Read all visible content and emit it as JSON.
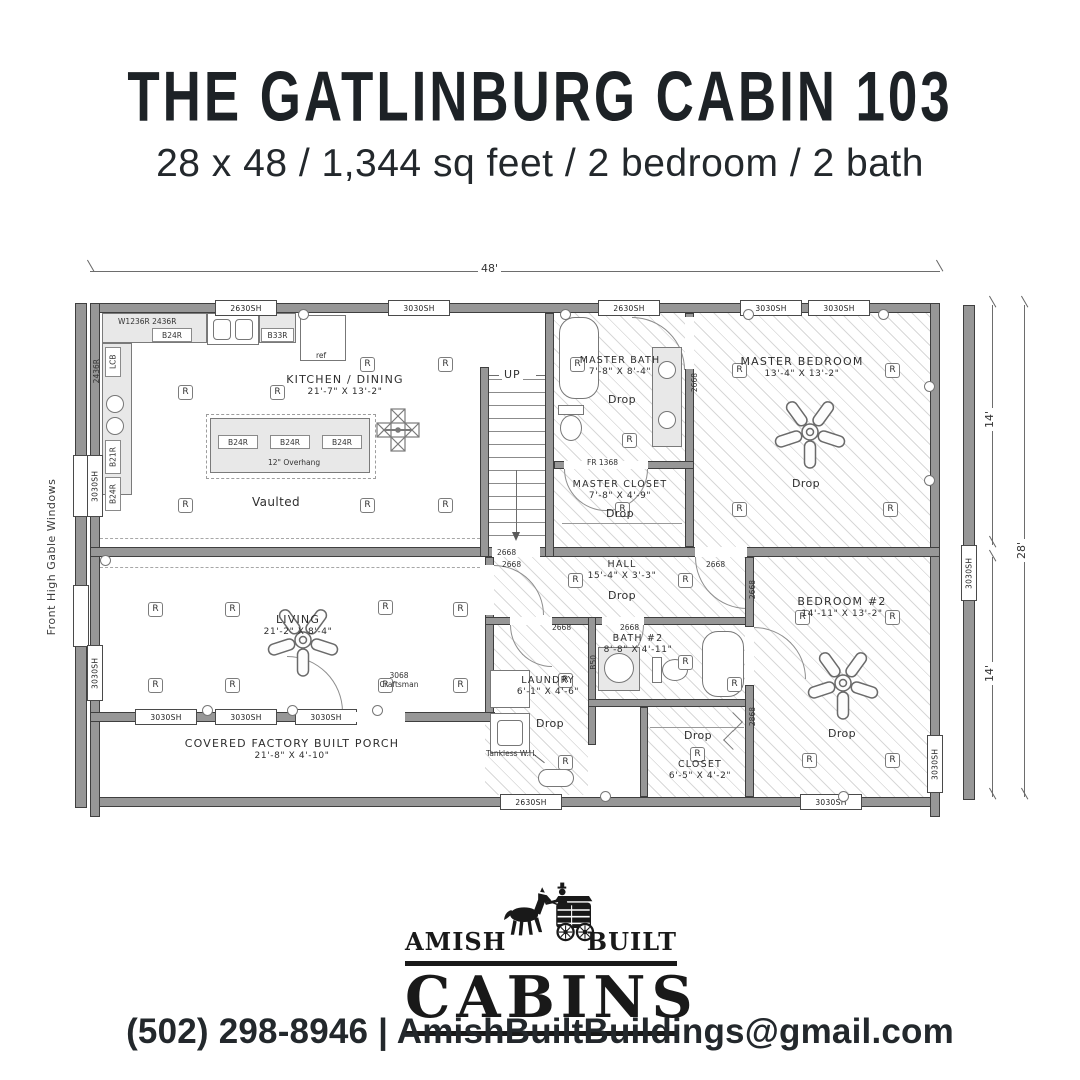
{
  "header": {
    "title": "THE GATLINBURG CABIN 103",
    "subtitle": "28 x 48 / 1,344 sq feet / 2 bedroom / 2 bath"
  },
  "plan": {
    "dimensions": {
      "width": "48'",
      "upper_depth": "14'",
      "lower_depth": "14'",
      "total_depth": "28'"
    },
    "side_note": "Front High Gable Windows",
    "labels": {
      "recessed": "R",
      "drop": "Drop",
      "up": "UP",
      "vaulted": "Vaulted",
      "tankless": "Tankless W.H.",
      "overhang": "12\" Overhang",
      "ref": "ref"
    },
    "rooms": {
      "kitchen": {
        "name": "KITCHEN / DINING",
        "dims": "21'-7\" X 13'-2\""
      },
      "master_bath": {
        "name": "MASTER BATH",
        "dims": "7'-8\" X 8'-4\""
      },
      "master_closet": {
        "name": "MASTER CLOSET",
        "dims": "7'-8\" X 4'-9\""
      },
      "master_bedroom": {
        "name": "MASTER BEDROOM",
        "dims": "13'-4\" X 13'-2\""
      },
      "hall": {
        "name": "HALL",
        "dims": "15'-4\" X 3'-3\""
      },
      "living": {
        "name": "LIVING",
        "dims": "21'-2\" X 8'-4\""
      },
      "laundry": {
        "name": "LAUNDRY",
        "dims": "6'-1\" X 4'-6\""
      },
      "bath2": {
        "name": "BATH #2",
        "dims": "8'-8\" X 4'-11\""
      },
      "closet": {
        "name": "CLOSET",
        "dims": "6'-5\" X 4'-2\""
      },
      "bedroom2": {
        "name": "BEDROOM #2",
        "dims": "14'-11\" X 13'-2\""
      },
      "porch": {
        "name": "COVERED FACTORY BUILT PORCH",
        "dims": "21'-8\" X 4'-10\""
      }
    },
    "windows": {
      "sh2630": "2630SH",
      "sh3030": "3030SH"
    },
    "doors": {
      "d2668": "2668",
      "d2868": "2868",
      "craftsman": "3068 Craftsman",
      "fr1368": "FR 1368",
      "b50": "B50"
    },
    "cabinets": {
      "b24r": "B24R",
      "b33r": "B33R",
      "b21r": "B21R",
      "lcb": "LCB",
      "w1236r": "W1236R",
      "w2436r": "2436R"
    }
  },
  "logo": {
    "left": "AMISH",
    "right": "BUILT",
    "name": "CABINS"
  },
  "footer": {
    "contact": "(502) 298-8946 | AmishBuiltBuildings@gmail.com"
  },
  "colors": {
    "ink": "#1e1e1e",
    "wall_gray": "#979797",
    "hatch_gray": "#d8d8d8"
  }
}
